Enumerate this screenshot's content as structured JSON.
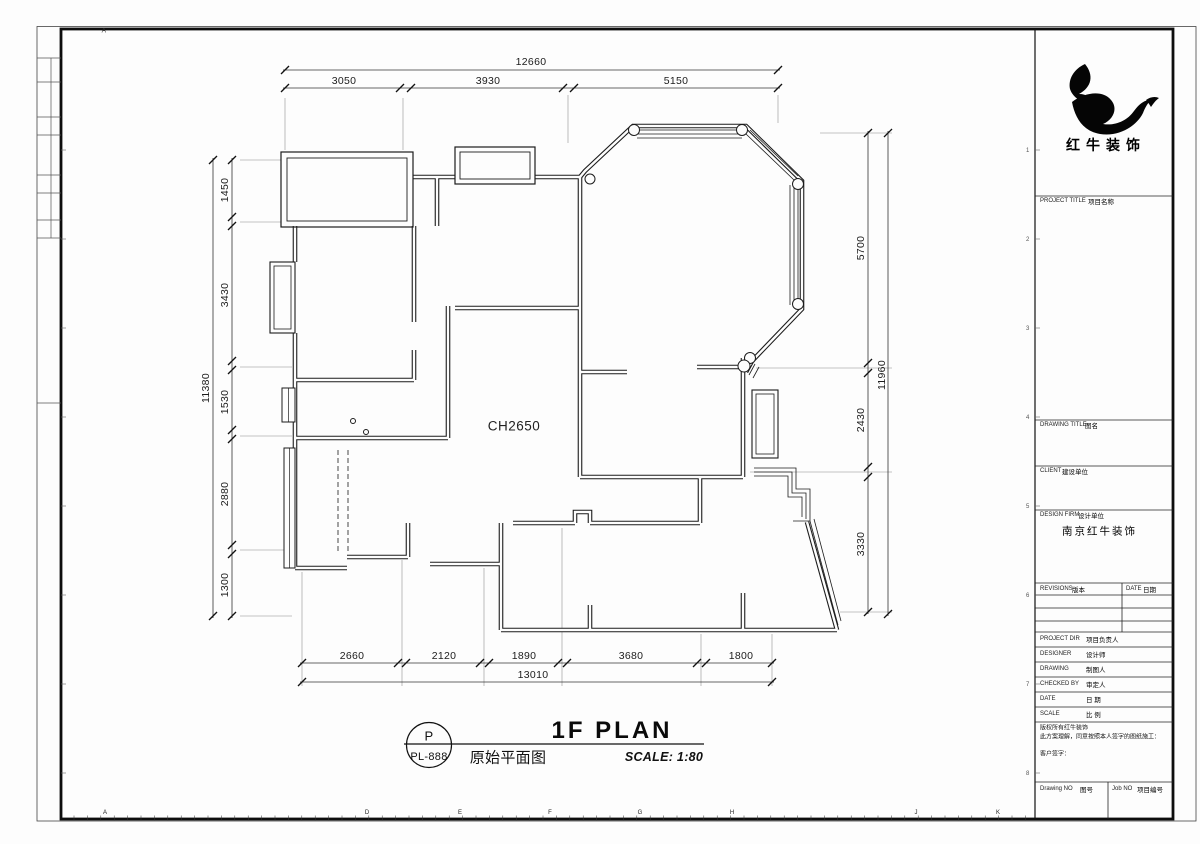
{
  "sheet": {
    "top_letter": "A",
    "ruler_letters": [
      {
        "ch": "A",
        "x": 105
      },
      {
        "ch": "D",
        "x": 367
      },
      {
        "ch": "E",
        "x": 460
      },
      {
        "ch": "F",
        "x": 550
      },
      {
        "ch": "G",
        "x": 640
      },
      {
        "ch": "H",
        "x": 732
      },
      {
        "ch": "J",
        "x": 916
      },
      {
        "ch": "K",
        "x": 998
      }
    ],
    "grid_refs": [
      {
        "n": "1",
        "y": 150
      },
      {
        "n": "2",
        "y": 239
      },
      {
        "n": "3",
        "y": 328
      },
      {
        "n": "4",
        "y": 417
      },
      {
        "n": "5",
        "y": 506
      },
      {
        "n": "6",
        "y": 595
      },
      {
        "n": "7",
        "y": 684
      },
      {
        "n": "8",
        "y": 773
      }
    ]
  },
  "plan": {
    "ceiling_label": "CH2650",
    "sheet_ref_letter": "P",
    "sheet_ref_number": "PL-888",
    "title": "1F PLAN",
    "title_cn": "原始平面图",
    "scale_text": "SCALE: 1:80"
  },
  "dimensions": {
    "top": {
      "overall": "12660",
      "segments": [
        "3050",
        "3930",
        "5150"
      ]
    },
    "bottom": {
      "overall": "13010",
      "segments": [
        "2660",
        "2120",
        "1890",
        "3680",
        "1800"
      ]
    },
    "left": {
      "overall": "11380",
      "segments": [
        "1450",
        "3430",
        "1530",
        "2880",
        "1300"
      ]
    },
    "right": {
      "overall": "11960",
      "segments": [
        "5700",
        "2430",
        "3330"
      ]
    }
  },
  "title_block": {
    "logo_text": "红牛装饰",
    "project_title_en": "PROJECT TITLE",
    "project_title_cn": "项目名称",
    "drawing_title_en": "DRAWING TITLE",
    "drawing_title_cn": "图名",
    "client_en": "CLIENT",
    "client_cn": "建设单位",
    "design_firm_en": "DESIGN FIRM",
    "design_firm_cn": "设计单位",
    "design_firm_value": "南京红牛装饰",
    "revisions_en": "REVISIONS",
    "revisions_cn": "版本",
    "rev_date_en": "DATE",
    "rev_date_cn": "日期",
    "project_dir_en": "PROJECT DIR",
    "project_dir_cn": "项目负责人",
    "designer_en": "DESIGNER",
    "designer_cn": "设计师",
    "drawing_en": "DRAWING",
    "drawing_cn": "制图人",
    "checked_by_en": "CHECKED BY",
    "checked_by_cn": "审定人",
    "date_en": "DATE",
    "date_cn": "日 期",
    "scale_en": "SCALE",
    "scale_cn": "比 例",
    "notes": [
      "版权所有红牛装饰",
      "此方案理解，同意按照本人签字的图纸施工：",
      "客户签字："
    ],
    "drawing_no_en": "Drawing NO",
    "drawing_no_cn": "图号",
    "job_no_en": "Job NO",
    "job_no_cn": "项目编号"
  }
}
